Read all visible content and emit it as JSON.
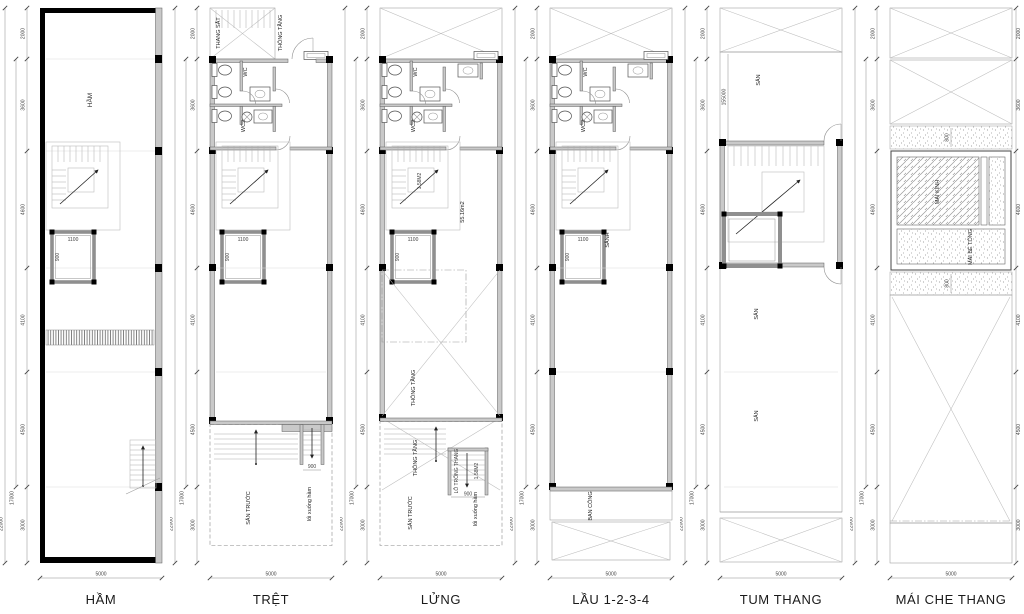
{
  "sheet": {
    "background": "#ffffff",
    "line_color": "#555555",
    "wall_gray": "#c9c9c9",
    "wall_black": "#000000"
  },
  "dims": {
    "segments": [
      "2000",
      "3600",
      "4600",
      "4100",
      "4500",
      "3000"
    ],
    "totals": [
      "17000",
      "22000"
    ],
    "width": "5000"
  },
  "shared": {
    "wc": "WC",
    "wc2": "WC2",
    "lift_w": "1100",
    "lift_d": "900",
    "stair_w": "900"
  },
  "panels": [
    {
      "id": "ham",
      "title": "HẦM",
      "labels": {
        "room": "HẦM"
      }
    },
    {
      "id": "tret",
      "title": "TRỆT",
      "labels": {
        "thang_sat": "THANG SẮT",
        "thong_tang": "THÔNG TẦNG",
        "san_truoc": "SÂN TRƯỚC",
        "loi_xuong_ham": "lối xuống hầm"
      }
    },
    {
      "id": "lung",
      "title": "LỬNG",
      "labels": {
        "stair_area": "1.58M2",
        "floor_area": "55.16m2",
        "thong_tang_1": "THÔNG TẦNG",
        "thong_tang_2": "THÔNG TẦNG",
        "lo_trong_thang": "LỖ TRỐNG THANG",
        "lo_area": "1.58M2",
        "san_truoc": "SÂN TRƯỚC",
        "loi_xuong_ham": "lối xuống hầm"
      }
    },
    {
      "id": "lau",
      "title": "LẦU 1-2-3-4",
      "labels": {
        "sanh": "SẢNH",
        "ban_cong": "BAN CÔNG"
      }
    },
    {
      "id": "tum",
      "title": "TUM THANG",
      "labels": {
        "san_1": "SÂN",
        "san_2": "SÂN",
        "san_3": "SÂN",
        "dim": "155000"
      }
    },
    {
      "id": "mai",
      "title": "MÁI CHE THANG",
      "labels": {
        "mai_kinh": "MÁI KÍNH",
        "mai_be_tong": "MÁI BÊ TÔNG",
        "dim_top": "800",
        "dim_bottom": "800"
      }
    }
  ]
}
